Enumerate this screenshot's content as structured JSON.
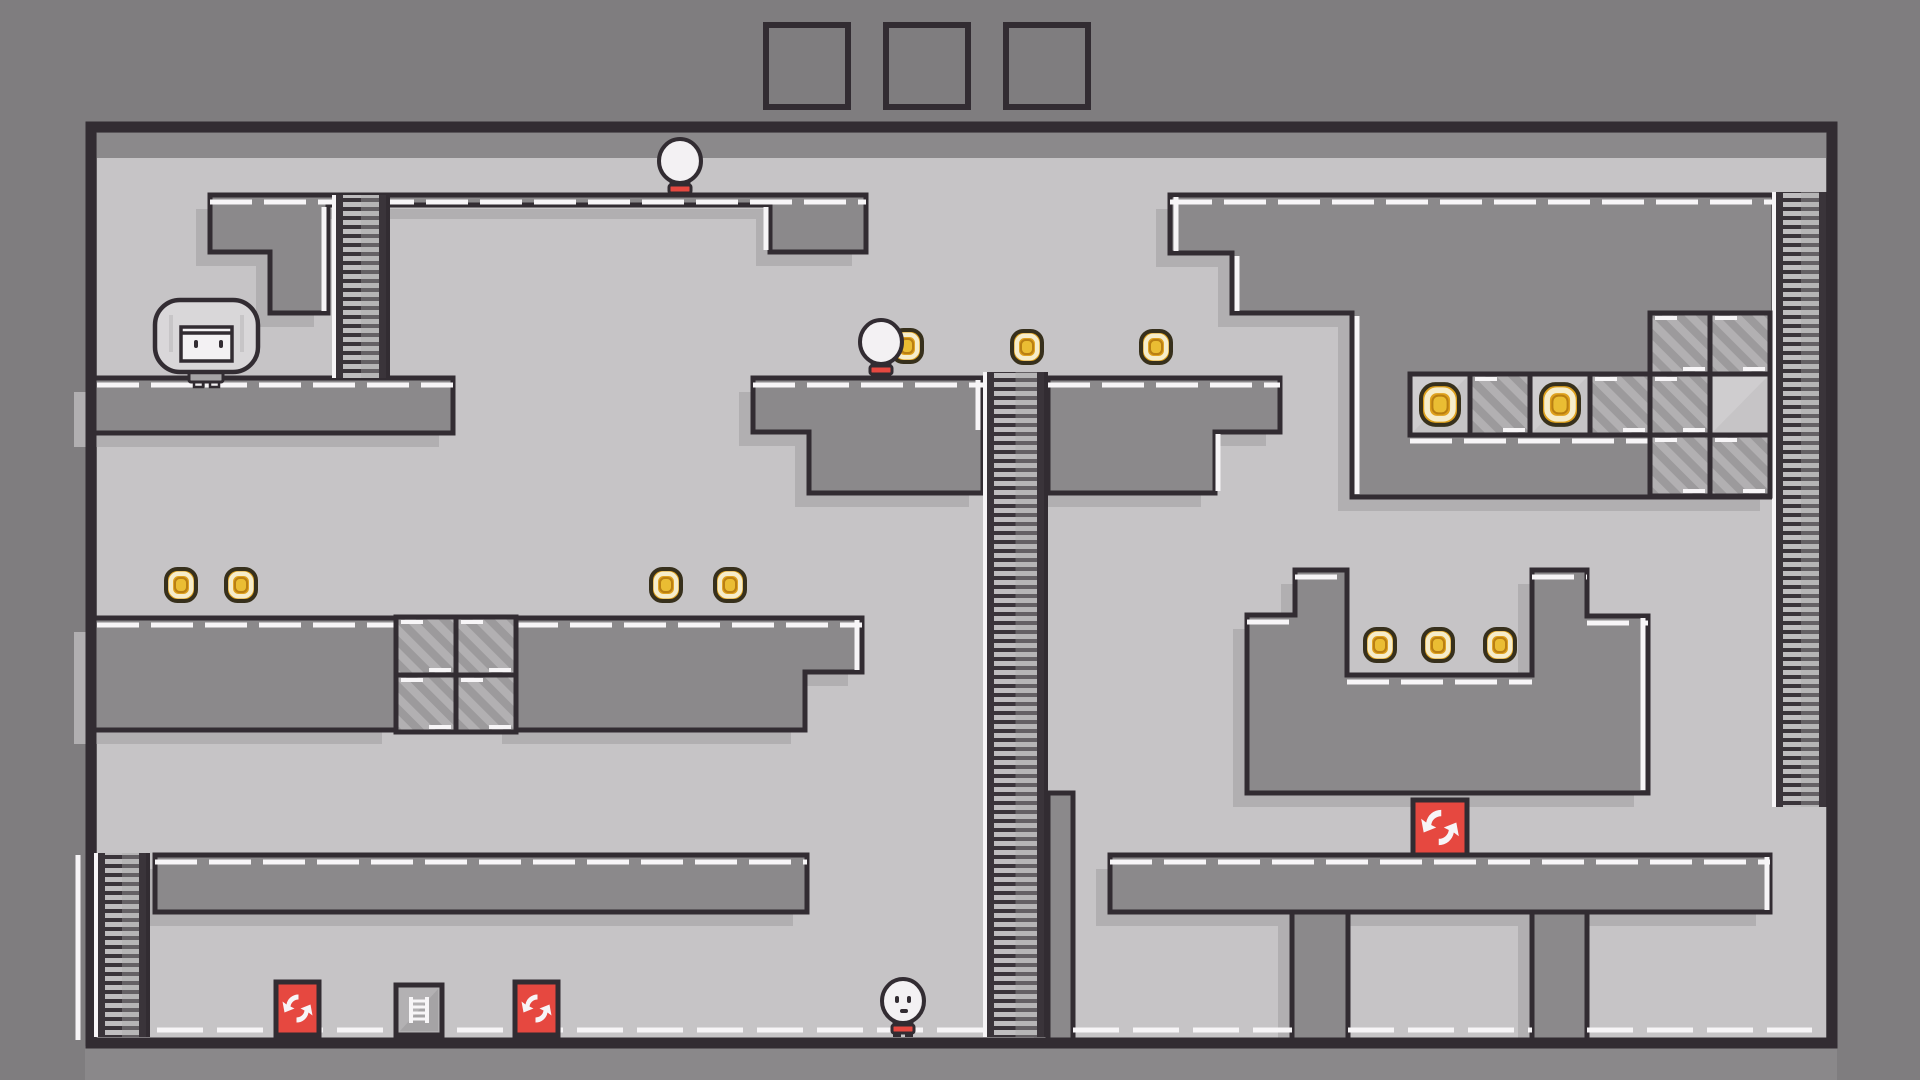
{
  "colors": {
    "outer_bg": "#7f7d7f",
    "play_bg": "#c6c4c6",
    "platform": "#8b898b",
    "bottom_band": "#8a888a",
    "outline": "#322c32",
    "white": "#f7f5f7",
    "shadow": "#b1afb1",
    "stripe_bg": "#b2b0b2",
    "stripe_dark": "#9c9a9c",
    "plain_tile": "#c6c4c6",
    "ladder_bg": "#bfbdbf",
    "ladder_rail": "#3a343a",
    "ladder_shade": "#a9a7a9",
    "coin_gold": "#dfa11d",
    "coin_pale": "#f6edcb",
    "coin_center": "#eabd33",
    "coin_outline": "#37301c",
    "coin_ring": "#b97f12",
    "item_red": "#e64840",
    "item_gray": "#b3b1b3",
    "char_white": "#f3f1f3",
    "char_shade": "#e2e0e2",
    "girl_hair": "#d9d7d9",
    "girl_dress": "#a5a3a5",
    "shorts_red": "#e64840"
  },
  "hud": {
    "slot_y": 25,
    "slot_size": 82,
    "slots": [
      {
        "x": 766
      },
      {
        "x": 886
      },
      {
        "x": 1006
      }
    ]
  },
  "level": {
    "play_area": {
      "x": 97,
      "y": 133,
      "w": 1729,
      "h": 907
    },
    "ceiling_band": {
      "x": 97,
      "y": 133,
      "w": 1729,
      "h": 25
    },
    "shadow_offset": [
      -14,
      14
    ],
    "structures": [
      {
        "name": "topleft-stair-floor",
        "points": [
          [
            210,
            195
          ],
          [
            866,
            195
          ],
          [
            866,
            252
          ],
          [
            770,
            252
          ],
          [
            770,
            205
          ],
          [
            328,
            205
          ],
          [
            328,
            313
          ],
          [
            270,
            313
          ],
          [
            270,
            252
          ],
          [
            210,
            252
          ]
        ]
      },
      {
        "name": "topleft-slab",
        "points": [
          [
            88,
            378
          ],
          [
            453,
            378
          ],
          [
            453,
            433
          ],
          [
            88,
            433
          ]
        ]
      },
      {
        "name": "midleft-platform-a",
        "points": [
          [
            88,
            618
          ],
          [
            396,
            618
          ],
          [
            396,
            730
          ],
          [
            88,
            730
          ]
        ]
      },
      {
        "name": "midleft-platform-b",
        "points": [
          [
            516,
            618
          ],
          [
            862,
            618
          ],
          [
            862,
            672
          ],
          [
            805,
            672
          ],
          [
            805,
            730
          ],
          [
            516,
            730
          ]
        ]
      },
      {
        "name": "midtop-platform-left",
        "points": [
          [
            753,
            378
          ],
          [
            983,
            378
          ],
          [
            983,
            493
          ],
          [
            809,
            493
          ],
          [
            809,
            432
          ],
          [
            753,
            432
          ]
        ]
      },
      {
        "name": "midtop-platform-right",
        "points": [
          [
            1048,
            378
          ],
          [
            1280,
            378
          ],
          [
            1280,
            432
          ],
          [
            1215,
            432
          ],
          [
            1215,
            493
          ],
          [
            1048,
            493
          ]
        ]
      },
      {
        "name": "righttop-structure",
        "points": [
          [
            1170,
            195
          ],
          [
            1774,
            195
          ],
          [
            1774,
            497
          ],
          [
            1352,
            497
          ],
          [
            1352,
            313
          ],
          [
            1232,
            313
          ],
          [
            1232,
            253
          ],
          [
            1170,
            253
          ]
        ]
      },
      {
        "name": "u-structure",
        "points": [
          [
            1247,
            615
          ],
          [
            1295,
            615
          ],
          [
            1295,
            570
          ],
          [
            1347,
            570
          ],
          [
            1347,
            675
          ],
          [
            1532,
            675
          ],
          [
            1532,
            570
          ],
          [
            1587,
            570
          ],
          [
            1587,
            616
          ],
          [
            1648,
            616
          ],
          [
            1648,
            793
          ],
          [
            1247,
            793
          ]
        ]
      },
      {
        "name": "bottom-pillar-mid",
        "points": [
          [
            1048,
            793
          ],
          [
            1073,
            793
          ],
          [
            1073,
            1040
          ],
          [
            1048,
            1040
          ]
        ]
      },
      {
        "name": "mezzanine-left",
        "points": [
          [
            155,
            855
          ],
          [
            807,
            855
          ],
          [
            807,
            912
          ],
          [
            155,
            912
          ]
        ]
      },
      {
        "name": "mezzanine-right",
        "points": [
          [
            1110,
            855
          ],
          [
            1770,
            855
          ],
          [
            1770,
            912
          ],
          [
            1110,
            912
          ]
        ]
      },
      {
        "name": "window-pillar-a",
        "points": [
          [
            1292,
            912
          ],
          [
            1348,
            912
          ],
          [
            1348,
            1040
          ],
          [
            1292,
            1040
          ]
        ]
      },
      {
        "name": "window-pillar-b",
        "points": [
          [
            1532,
            912
          ],
          [
            1587,
            912
          ],
          [
            1587,
            1040
          ],
          [
            1532,
            1040
          ]
        ]
      }
    ],
    "top_edge_dashes": [
      [
        210,
        866,
        202
      ],
      [
        97,
        453,
        385
      ],
      [
        97,
        396,
        625
      ],
      [
        516,
        862,
        625
      ],
      [
        753,
        983,
        385
      ],
      [
        1048,
        1280,
        385
      ],
      [
        1170,
        1774,
        202
      ],
      [
        1247,
        1295,
        622
      ],
      [
        1295,
        1347,
        577
      ],
      [
        1347,
        1532,
        682
      ],
      [
        1532,
        1587,
        577
      ],
      [
        1587,
        1648,
        623
      ],
      [
        155,
        807,
        862
      ],
      [
        1110,
        1770,
        862
      ],
      [
        1410,
        1648,
        441
      ]
    ],
    "floor_dashes_y": 1030,
    "floor_dashes": [
      [
        97,
        1048
      ],
      [
        1073,
        1292
      ],
      [
        1348,
        1532
      ],
      [
        1587,
        1812
      ]
    ],
    "white_vlines": [
      [
        78,
        855,
        1040
      ],
      [
        766,
        207,
        250
      ],
      [
        324,
        207,
        311
      ],
      [
        1176,
        197,
        251
      ],
      [
        1237,
        256,
        311
      ],
      [
        1357,
        316,
        494
      ],
      [
        1218,
        434,
        491
      ],
      [
        1767,
        857,
        910
      ],
      [
        1643,
        618,
        790
      ],
      [
        857,
        620,
        670
      ],
      [
        978,
        380,
        430
      ]
    ],
    "ladders": [
      {
        "name": "ladder-topleft",
        "x": 332,
        "y": 195,
        "w": 58,
        "h": 183
      },
      {
        "name": "ladder-tall-middle",
        "x": 983,
        "y": 372,
        "w": 65,
        "h": 665
      },
      {
        "name": "ladder-right",
        "x": 1772,
        "y": 192,
        "w": 58,
        "h": 615
      },
      {
        "name": "ladder-bottomleft",
        "x": 94,
        "y": 853,
        "w": 56,
        "h": 184
      }
    ],
    "striped_tiles": [
      [
        396,
        617,
        60,
        58
      ],
      [
        456,
        617,
        60,
        58
      ],
      [
        396,
        675,
        60,
        57
      ],
      [
        456,
        675,
        60,
        57
      ],
      [
        1470,
        374,
        60,
        61
      ],
      [
        1590,
        374,
        60,
        61
      ],
      [
        1650,
        313,
        60,
        61
      ],
      [
        1710,
        313,
        60,
        61
      ],
      [
        1650,
        374,
        60,
        61
      ],
      [
        1650,
        435,
        60,
        61
      ],
      [
        1710,
        435,
        60,
        61
      ]
    ],
    "plain_tiles": [
      [
        1710,
        374,
        60,
        61
      ]
    ],
    "coin_tiles": [
      [
        1410,
        374,
        60,
        61
      ],
      [
        1530,
        374,
        60,
        61
      ]
    ],
    "coins": [
      [
        181,
        585
      ],
      [
        241,
        585
      ],
      [
        666,
        585
      ],
      [
        730,
        585
      ],
      [
        1027,
        347
      ],
      [
        1156,
        347
      ],
      [
        1380,
        645
      ],
      [
        1438,
        645
      ],
      [
        1500,
        645
      ],
      [
        907,
        346
      ]
    ],
    "swap_tiles": [
      [
        276,
        982,
        43,
        53
      ],
      [
        515,
        982,
        43,
        53
      ],
      [
        1413,
        800,
        54,
        55
      ]
    ],
    "ladder_item_tiles": [
      [
        396,
        985,
        46,
        50
      ]
    ],
    "characters": [
      {
        "name": "character-girl",
        "type": "girl",
        "cx": 206,
        "ground": 387
      },
      {
        "name": "character-kid-top",
        "type": "kid",
        "cx": 680,
        "ground": 197,
        "face": "none"
      },
      {
        "name": "character-kid-middle",
        "type": "kid",
        "cx": 881,
        "ground": 378,
        "face": "none"
      },
      {
        "name": "character-kid-bottom",
        "type": "kid",
        "cx": 903,
        "ground": 1037,
        "face": "smile"
      }
    ]
  }
}
